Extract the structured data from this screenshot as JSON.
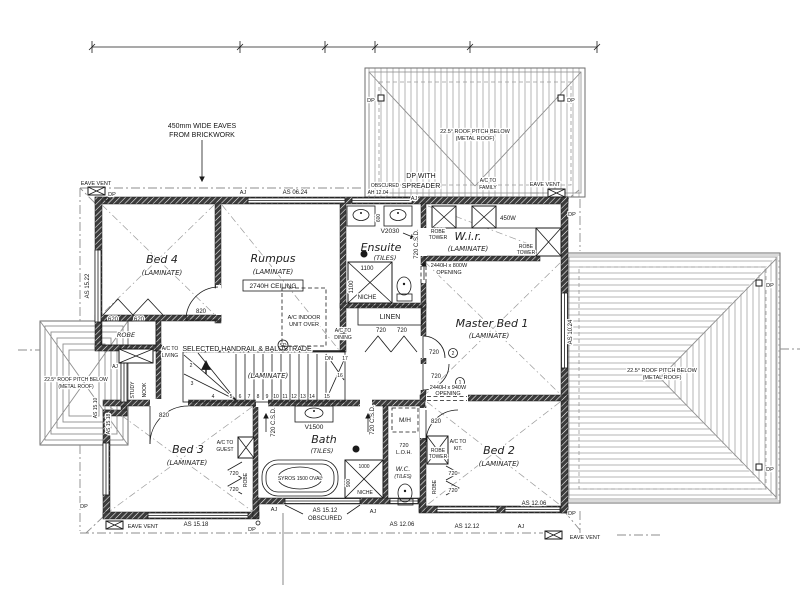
{
  "drawing": {
    "annotations": {
      "eaves_note1": "450mm WIDE EAVES",
      "eaves_note2": "FROM BRICKWORK",
      "dp_spreader1": "DP WITH",
      "dp_spreader2": "SPREADER",
      "obscured": "OBSCURED",
      "ah1204": "AH 12.04",
      "handrail": "SELECTED HANDRAIL & BALUSTRADE",
      "opening800a": "2440H x 800W",
      "opening940a": "2440H x 940W",
      "opening_b": "OPENING",
      "as1512a": "AS 15.12",
      "as1512b": "OBSCURED"
    },
    "markers": {
      "dp": "DP",
      "aj": "AJ",
      "eave_vent": "EAVE VENT",
      "sd": "SD",
      "dn": "DN",
      "mh": "M/H"
    },
    "roof": {
      "pitch1": "22.5° ROOF PITCH BELOW",
      "pitch2": "(METAL ROOF)"
    },
    "rooms": {
      "bed4": "Bed 4",
      "bed4_fin": "(LAMINATE)",
      "rumpus": "Rumpus",
      "rumpus_fin": "(LAMINATE)",
      "rumpus_ceiling": "2740H CEILING",
      "ensuite": "Ensuite",
      "ensuite_fin": "(TILES)",
      "wir": "W.i.r.",
      "wir_fin": "(LAMINATE)",
      "master": "Master Bed 1",
      "master_fin": "(LAMINATE)",
      "bed3": "Bed 3",
      "bed3_fin": "(LAMINATE)",
      "bath": "Bath",
      "bath_fin": "(TILES)",
      "wc": "W.C.",
      "wc_fin": "(TILES)",
      "bed2": "Bed 2",
      "bed2_fin": "(LAMINATE)",
      "linen": "LINEN",
      "robe": "ROBE",
      "robe_tower1": "ROBE",
      "robe_tower2": "TOWER",
      "study1": "STUDY",
      "study2": "NOOK",
      "stair_fin": "(LAMINATE)"
    },
    "ac": {
      "prefix": "A/C TO",
      "living": "LIVING",
      "guest": "GUEST",
      "dining": "DINING",
      "family": "FAMILY",
      "kitchen": "KIT.",
      "indoor1": "A/C INDOOR",
      "indoor2": "UNIT OVER"
    },
    "fixtures": {
      "v2030": "V2030",
      "v1500": "V1500",
      "bath_model": "SYROS 1500 OVAL",
      "niche": "NICHE",
      "n1100": "1100",
      "n1000": "1000",
      "n900": "900",
      "n600": "600",
      "shelf": "450W",
      "loh1": "720",
      "loh2": "L.O.H."
    },
    "doors": {
      "d820": "820",
      "d720": "720",
      "d620": "620",
      "csd": "720 C.S.D.",
      "tag1": "1",
      "tag2": "2"
    },
    "windows": {
      "as0624": "AS 06.24",
      "as1522": "AS 15.22",
      "as1024": "AS 10.24",
      "as1510": "AS 15.10",
      "as1518": "AS 15.18",
      "as1206": "AS 12.06",
      "as1212": "AS 12.12"
    },
    "stairs": {
      "numbers": [
        "2",
        "3",
        "4",
        "5",
        "6",
        "7",
        "8",
        "9",
        "10",
        "11",
        "12",
        "13",
        "14",
        "15",
        "16",
        "17"
      ]
    }
  }
}
